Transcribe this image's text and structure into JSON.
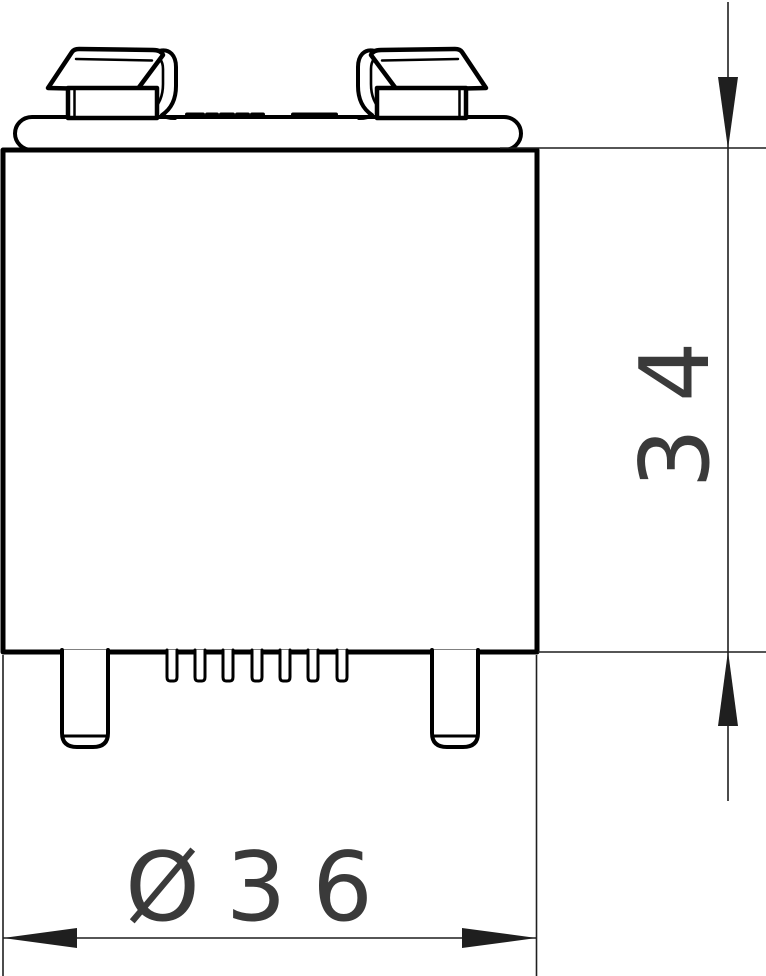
{
  "drawing": {
    "dimensions": {
      "height": {
        "value": "34"
      },
      "diameter": {
        "value": "Ø36"
      }
    },
    "colors": {
      "outline": "#000000",
      "dim_line": "#1f1f1f",
      "dim_text": "#3a3a3a",
      "background": "#ffffff"
    },
    "features": {
      "terminals": 2,
      "legs": 2,
      "pins": 7
    }
  }
}
